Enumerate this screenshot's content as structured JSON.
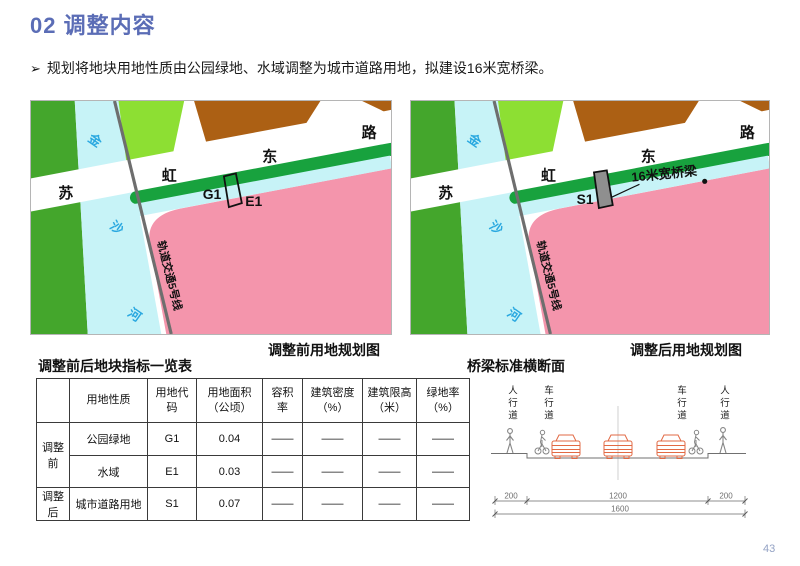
{
  "page": {
    "title": "02 调整内容",
    "bullet_marker": "➢",
    "bullet": "规划将地块用地性质由公园绿地、水域调整为城市道路用地，拟建设16米宽桥梁。",
    "page_number": "43"
  },
  "maps": {
    "before": {
      "caption": "调整前用地规划图",
      "road_labels": [
        "苏",
        "虹",
        "东",
        "路"
      ],
      "river_labels": [
        "金",
        "沙",
        "河"
      ],
      "rail_label": "轨道交通5号线",
      "plot_labels": {
        "green": "G1",
        "water": "E1"
      }
    },
    "after": {
      "caption": "调整后用地规划图",
      "road_labels": [
        "苏",
        "虹",
        "东",
        "路"
      ],
      "river_labels": [
        "金",
        "沙",
        "河"
      ],
      "rail_label": "轨道交通5号线",
      "plot_label": "S1",
      "bridge_annotation": "16米宽桥梁"
    }
  },
  "table": {
    "title": "调整前后地块指标一览表",
    "headers": [
      "",
      "用地性质",
      "用地代\n码",
      "用地面积\n（公顷）",
      "容积\n率",
      "建筑密度\n（%）",
      "建筑限高\n（米）",
      "绿地率\n（%）"
    ],
    "groups": [
      {
        "label": "调整前"
      },
      {
        "label": "调整后"
      }
    ],
    "rows": [
      {
        "use": "公园绿地",
        "code": "G1",
        "area": "0.04",
        "far": "——",
        "density": "——",
        "height_limit": "——",
        "green_rate": "——"
      },
      {
        "use": "水域",
        "code": "E1",
        "area": "0.03",
        "far": "——",
        "density": "——",
        "height_limit": "——",
        "green_rate": "——"
      },
      {
        "use": "城市道路用地",
        "code": "S1",
        "area": "0.07",
        "far": "——",
        "density": "——",
        "height_limit": "——",
        "green_rate": "——"
      }
    ]
  },
  "cross_section": {
    "title": "桥梁标准横断面",
    "lane_labels": [
      "人行道",
      "车行道",
      "车行道",
      "人行道"
    ],
    "dimensions": {
      "left": "200",
      "middle": "1200",
      "right": "200",
      "total": "1600"
    }
  },
  "colors": {
    "title_blue": "#5b6db6",
    "park_green": "#44a62c",
    "road_strip_green": "#18a23e",
    "light_green": "#8ddf33",
    "water_cyan": "#c7f3f7",
    "residential_pink": "#f495ac",
    "brown": "#ac6014",
    "rail_gray": "#6e6e6e",
    "bridge_gray": "#8f8f8f",
    "car_orange": "#e26a44",
    "page_number_gray": "#93a2c4"
  }
}
